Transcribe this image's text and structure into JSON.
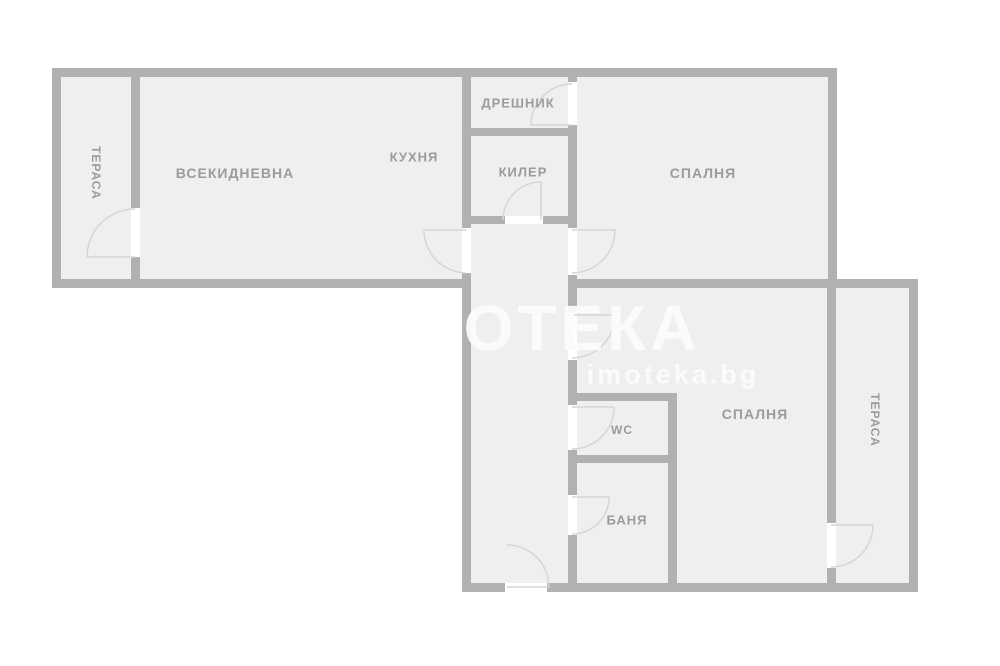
{
  "watermark": {
    "logo": "ОТЕКА",
    "site": "imoteka.bg"
  },
  "rooms": {
    "terrace_left": "ТЕРАСА",
    "living": "ВСЕКИДНЕВНА",
    "kitchen": "КУХНЯ",
    "dressing": "ДРЕШНИК",
    "pantry": "КИЛЕР",
    "bedroom_top": "СПАЛНЯ",
    "bedroom_bottom": "СПАЛНЯ",
    "wc": "WC",
    "bath": "БАНЯ",
    "terrace_right": "ТЕРАСА"
  },
  "colors": {
    "wall": "#b1b1b1",
    "room_fill": "#efefef",
    "label": "#9b9b9b",
    "door_arc": "#d6d6d6",
    "background": "#ffffff"
  }
}
